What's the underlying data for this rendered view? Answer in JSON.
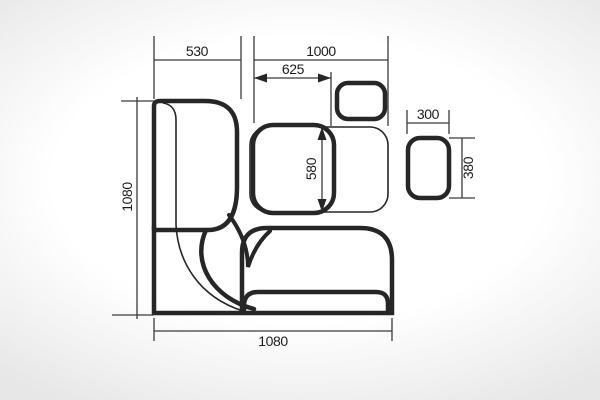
{
  "diagram": {
    "title": "corner-bench-seating-plan-top-view",
    "line_color": "#262626",
    "dims": {
      "top_left_width": {
        "value": "530",
        "unit_note": "width of left bench section"
      },
      "top_right_width": {
        "value": "1000",
        "unit_note": "width of right bench section"
      },
      "table_width": {
        "value": "625",
        "unit_note": "table width, double-arrow"
      },
      "table_depth": {
        "value": "580",
        "unit_note": "table depth, double-arrow"
      },
      "left_total": {
        "value": "1080",
        "unit_note": "total depth, left side"
      },
      "bottom_total": {
        "value": "1080",
        "unit_note": "total width, bottom"
      },
      "stool_width": {
        "value": "300",
        "unit_note": "stool width"
      },
      "stool_depth": {
        "value": "380",
        "unit_note": "stool depth"
      }
    },
    "parts": [
      "left-bench",
      "corner-seat",
      "bottom-bench",
      "bench-seat-panel",
      "table-top",
      "stool-small",
      "stool-right"
    ]
  }
}
